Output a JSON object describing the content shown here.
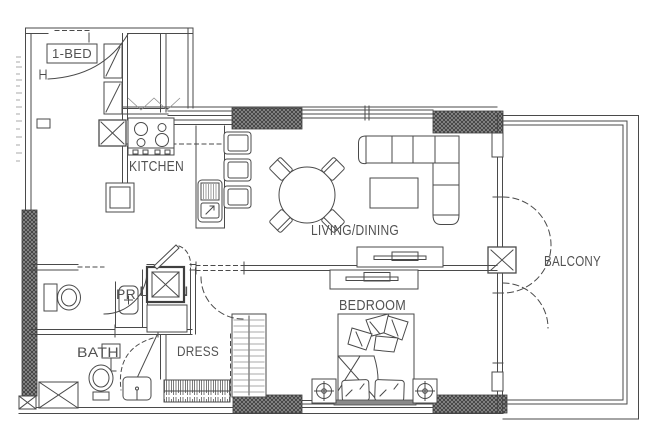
{
  "plan": {
    "unit_label": "1-BED",
    "rooms": {
      "kitchen": "KITCHEN",
      "living_dining": "LIVING/DINING",
      "balcony": "BALCONY",
      "powder_room": "PR",
      "laundry": "LAUN",
      "bath": "BATH",
      "dress": "DRESS",
      "bedroom": "BEDROOM"
    },
    "colors": {
      "background": "#ffffff",
      "line": "#4a4a4a",
      "text": "#525252",
      "column_fill": "#919191",
      "column_hatch": "#3c3c3c"
    },
    "fixtures": [
      "entry-door-swing",
      "stove",
      "kitchen-sink",
      "fridge",
      "bar-stools",
      "dining-table",
      "dining-chairs",
      "sofa",
      "coffee-table",
      "tv-console-living",
      "tv-console-bedroom",
      "double-bed",
      "nightstand-lamps",
      "washer",
      "laundry-counter",
      "pr-toilet",
      "pr-washbasin",
      "bath-toilet",
      "bath-vanity",
      "shower",
      "pedestal-sink",
      "wardrobe",
      "clothes-rail",
      "balcony-door-swings"
    ]
  }
}
